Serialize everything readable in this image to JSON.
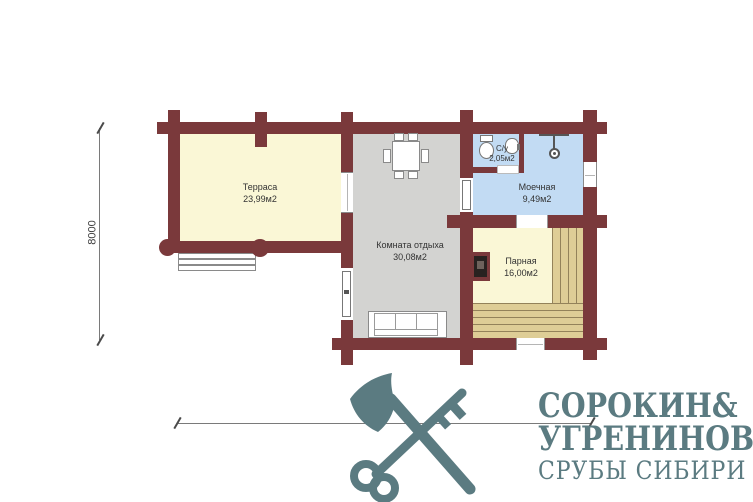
{
  "plan": {
    "rooms": [
      {
        "id": "terrace",
        "name": "Терраса",
        "area": "23,99м2"
      },
      {
        "id": "lounge",
        "name": "Комната отдыха",
        "area": "30,08м2"
      },
      {
        "id": "wc",
        "name": "С/у",
        "area": "2,05м2"
      },
      {
        "id": "washroom",
        "name": "Моечная",
        "area": "9,49м2"
      },
      {
        "id": "steam",
        "name": "Парная",
        "area": "16,00м2"
      }
    ],
    "dimensions": {
      "vertical": "8000",
      "horizontal": "15500"
    },
    "colors": {
      "wall": "#7A393B",
      "floor_warm": "#FAF7D6",
      "floor_gray": "#D3D3D1",
      "floor_blue": "#C2DBF3",
      "bench": "#DECD96",
      "bench_line": "#93825A",
      "logo": "#5B7B81",
      "dim_line": "#7A7A7A",
      "label_text": "#333333"
    }
  },
  "logo": {
    "name1": "СОРОКИН",
    "ampersand": "&",
    "name2": "УГРЕНИНОВ",
    "tagline": "СРУБЫ СИБИРИ"
  }
}
